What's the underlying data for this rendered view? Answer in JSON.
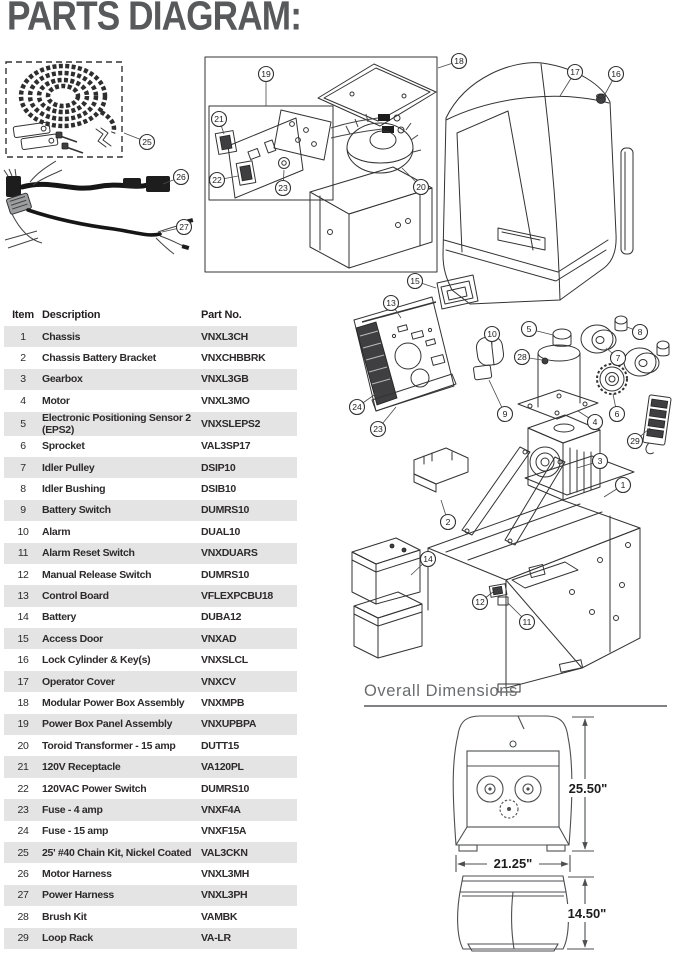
{
  "title": "PARTS DIAGRAM:",
  "table": {
    "headers": [
      "Item",
      "Description",
      "Part No."
    ],
    "rows": [
      [
        "1",
        "Chassis",
        "VNXL3CH"
      ],
      [
        "2",
        "Chassis Battery Bracket",
        "VNXCHBBRK"
      ],
      [
        "3",
        "Gearbox",
        "VNXL3GB"
      ],
      [
        "4",
        "Motor",
        "VNXL3MO"
      ],
      [
        "5",
        "Electronic Positioning Sensor 2 (EPS2)",
        "VNXSLEPS2"
      ],
      [
        "6",
        "Sprocket",
        "VAL3SP17"
      ],
      [
        "7",
        "Idler Pulley",
        "DSIP10"
      ],
      [
        "8",
        "Idler Bushing",
        "DSIB10"
      ],
      [
        "9",
        "Battery Switch",
        "DUMRS10"
      ],
      [
        "10",
        "Alarm",
        "DUAL10"
      ],
      [
        "11",
        "Alarm Reset Switch",
        "VNXDUARS"
      ],
      [
        "12",
        "Manual Release Switch",
        "DUMRS10"
      ],
      [
        "13",
        "Control Board",
        "VFLEXPCBU18"
      ],
      [
        "14",
        "Battery",
        "DUBA12"
      ],
      [
        "15",
        "Access Door",
        "VNXAD"
      ],
      [
        "16",
        "Lock Cylinder & Key(s)",
        "VNXSLCL"
      ],
      [
        "17",
        "Operator Cover",
        "VNXCV"
      ],
      [
        "18",
        "Modular Power Box Assembly",
        "VNXMPB"
      ],
      [
        "19",
        "Power Box Panel Assembly",
        "VNXUPBPA"
      ],
      [
        "20",
        "Toroid Transformer - 15 amp",
        "DUTT15"
      ],
      [
        "21",
        "120V Receptacle",
        "VA120PL"
      ],
      [
        "22",
        "120VAC Power Switch",
        "DUMRS10"
      ],
      [
        "23",
        "Fuse - 4 amp",
        "VNXF4A"
      ],
      [
        "24",
        "Fuse - 15 amp",
        "VNXF15A"
      ],
      [
        "25",
        "25' #40 Chain Kit, Nickel Coated",
        "VAL3CKN"
      ],
      [
        "26",
        "Motor Harness",
        "VNXL3MH"
      ],
      [
        "27",
        "Power Harness",
        "VNXL3PH"
      ],
      [
        "28",
        "Brush Kit",
        "VAMBK"
      ],
      [
        "29",
        "Loop Rack",
        "VA-LR"
      ]
    ]
  },
  "diagram": {
    "callouts": [
      {
        "n": "25",
        "x": 147,
        "y": 142,
        "tx": 124,
        "ty": 133
      },
      {
        "n": "26",
        "x": 181,
        "y": 177,
        "tx": 163,
        "ty": 184
      },
      {
        "n": "27",
        "x": 184,
        "y": 227,
        "tx": 162,
        "ty": 232
      },
      {
        "n": "19",
        "x": 266,
        "y": 74,
        "tx": 266,
        "ty": 106
      },
      {
        "n": "18",
        "x": 459,
        "y": 61,
        "tx": 438,
        "ty": 68
      },
      {
        "n": "21",
        "x": 219,
        "y": 119,
        "tx": 224,
        "ty": 134
      },
      {
        "n": "22",
        "x": 217,
        "y": 180,
        "tx": 238,
        "ty": 176
      },
      {
        "n": "23",
        "x": 283,
        "y": 188,
        "tx": 284,
        "ty": 170
      },
      {
        "n": "20",
        "x": 421,
        "y": 187,
        "tx": 402,
        "ty": 168
      },
      {
        "n": "17",
        "x": 575,
        "y": 72,
        "tx": 560,
        "ty": 96
      },
      {
        "n": "16",
        "x": 616,
        "y": 74,
        "tx": 604,
        "ty": 96
      },
      {
        "n": "15",
        "x": 415,
        "y": 281,
        "tx": 436,
        "ty": 288
      },
      {
        "n": "13",
        "x": 391,
        "y": 303,
        "tx": 401,
        "ty": 318
      },
      {
        "n": "5",
        "x": 529,
        "y": 329,
        "tx": 553,
        "ty": 335
      },
      {
        "n": "10",
        "x": 492,
        "y": 334,
        "tx": 492,
        "ty": 346
      },
      {
        "n": "28",
        "x": 522,
        "y": 357,
        "tx": 542,
        "ty": 360
      },
      {
        "n": "8",
        "x": 640,
        "y": 332,
        "tx": 627,
        "ty": 327
      },
      {
        "n": "7",
        "x": 618,
        "y": 358,
        "tx": 606,
        "ty": 348
      },
      {
        "n": "9",
        "x": 505,
        "y": 414,
        "tx": 489,
        "ty": 380
      },
      {
        "n": "24",
        "x": 357,
        "y": 407,
        "tx": 377,
        "ty": 393
      },
      {
        "n": "23",
        "x": 378,
        "y": 429,
        "tx": 396,
        "ty": 407
      },
      {
        "n": "6",
        "x": 617,
        "y": 414,
        "tx": 613,
        "ty": 394
      },
      {
        "n": "4",
        "x": 595,
        "y": 422,
        "tx": 578,
        "ty": 411
      },
      {
        "n": "29",
        "x": 635,
        "y": 441,
        "tx": 650,
        "ty": 428
      },
      {
        "n": "3",
        "x": 600,
        "y": 461,
        "tx": 577,
        "ty": 468
      },
      {
        "n": "1",
        "x": 623,
        "y": 485,
        "tx": 604,
        "ty": 497
      },
      {
        "n": "2",
        "x": 448,
        "y": 522,
        "tx": 441,
        "ty": 500
      },
      {
        "n": "14",
        "x": 428,
        "y": 559,
        "tx": 411,
        "ty": 575
      },
      {
        "n": "12",
        "x": 480,
        "y": 602,
        "tx": 493,
        "ty": 592
      },
      {
        "n": "11",
        "x": 527,
        "y": 622,
        "tx": 508,
        "ty": 603
      }
    ]
  },
  "dimensions": {
    "heading": "Overall Dimensions",
    "height": "25.50\"",
    "width": "21.25\"",
    "depth": "14.50\""
  }
}
